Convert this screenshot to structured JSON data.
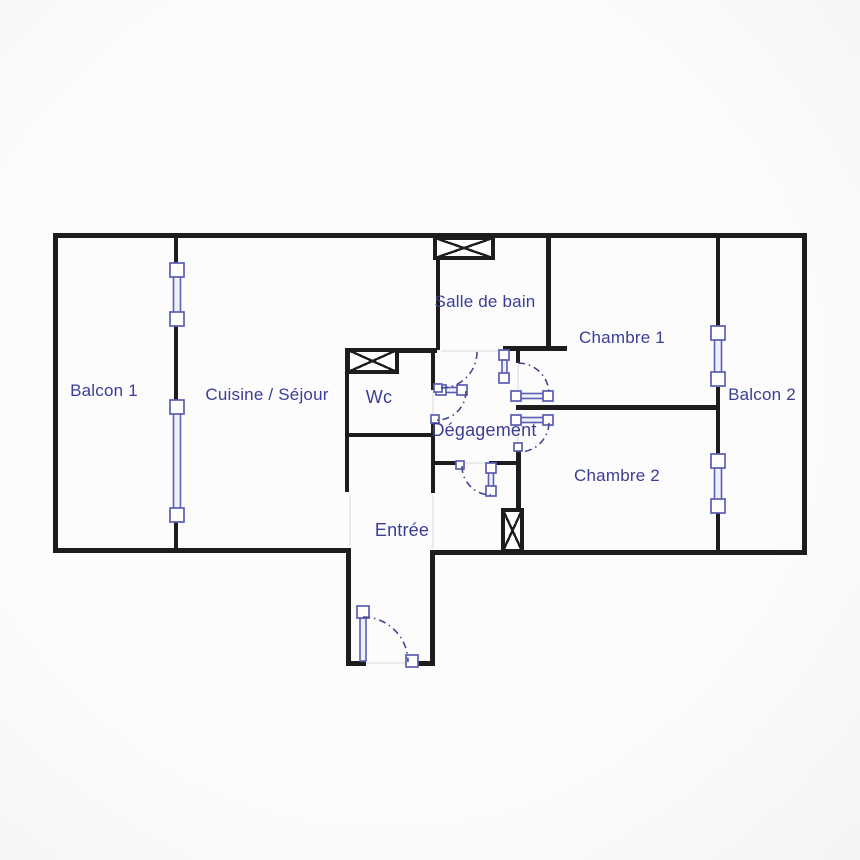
{
  "floor_plan": {
    "rooms": {
      "balcon_1": "Balcon 1",
      "cuisine_sejour": "Cuisine / Séjour",
      "wc": "Wc",
      "salle_de_bain": "Salle de bain",
      "chambre_1": "Chambre 1",
      "degagement": "Dégagement",
      "chambre_2": "Chambre 2",
      "balcon_2": "Balcon 2",
      "entree": "Entrée"
    },
    "colors": {
      "background": "#fafafa",
      "wall": "#1d1d1d",
      "fixture_blue": "#5b5eb2",
      "door_arc_blue": "#44478f",
      "label_text_blue": "#3a3e96"
    }
  }
}
